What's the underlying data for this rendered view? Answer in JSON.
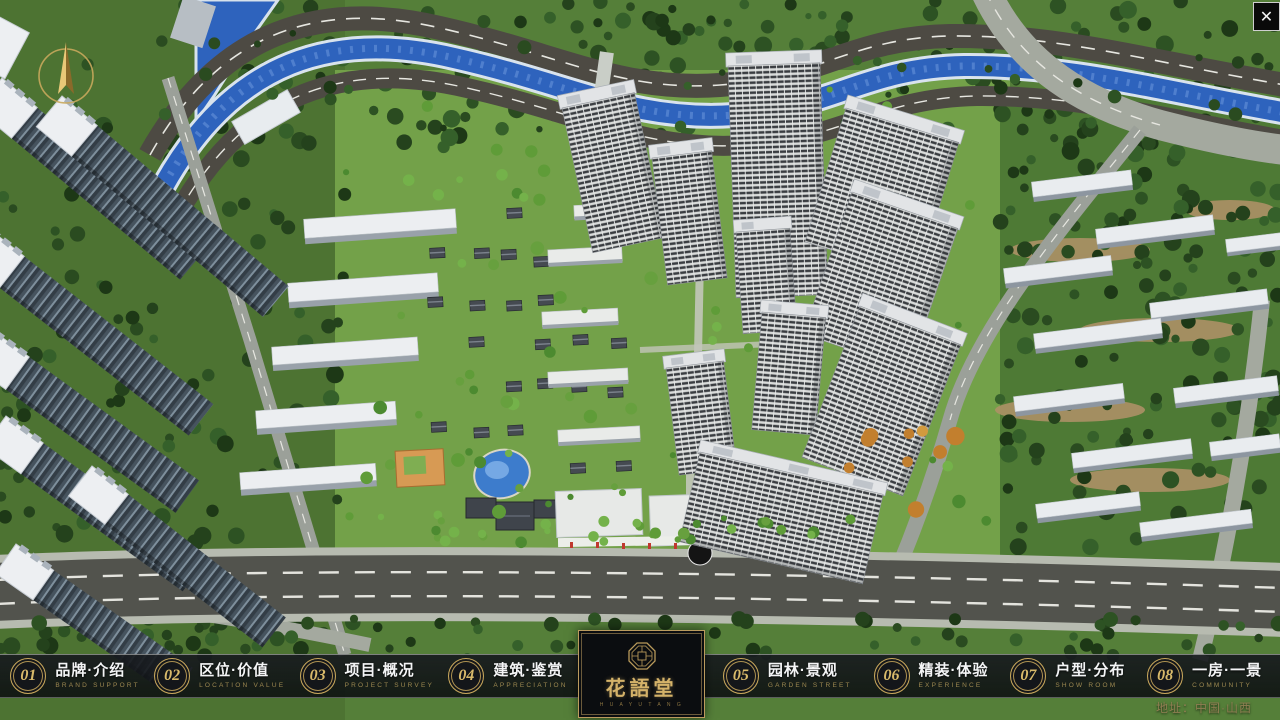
{
  "theme": {
    "gold": "#c9a85c",
    "navBackground": "#14161a",
    "riverBlue": "#2e63bd",
    "roadGray": "#52534d"
  },
  "window": {
    "close_label": "✕"
  },
  "scene": {
    "address": "地址：中国·山西"
  },
  "logo": {
    "title": "花語堂",
    "subtitle": "H U A Y U T A N G"
  },
  "nav": {
    "items": [
      {
        "num": "01",
        "zh": "品牌·介绍",
        "en": "BRAND SUPPORT"
      },
      {
        "num": "02",
        "zh": "区位·价值",
        "en": "LOCATION VALUE"
      },
      {
        "num": "03",
        "zh": "项目·概况",
        "en": "PROJECT SURVEY"
      },
      {
        "num": "04",
        "zh": "建筑·鉴赏",
        "en": "APPRECIATION"
      },
      {
        "num": "05",
        "zh": "园林·景观",
        "en": "GARDEN STREET"
      },
      {
        "num": "06",
        "zh": "精装·体验",
        "en": "EXPERIENCE"
      },
      {
        "num": "07",
        "zh": "户型·分布",
        "en": "SHOW ROOM"
      },
      {
        "num": "08",
        "zh": "一房·一景",
        "en": "COMMUNITY"
      }
    ]
  }
}
